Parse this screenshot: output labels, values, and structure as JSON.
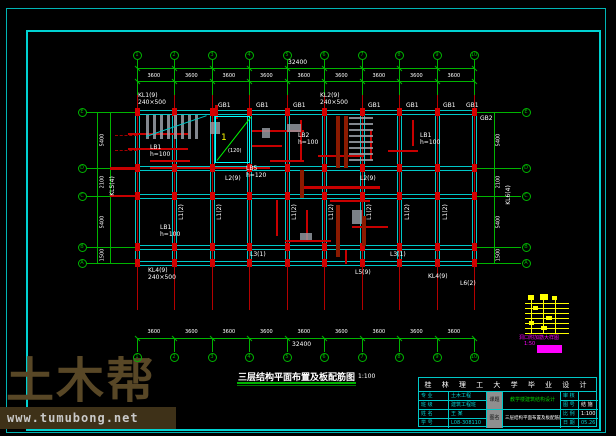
{
  "watermark": {
    "logo_text": "土木帮",
    "site_text": "www.tumubong.net"
  },
  "drawing_title": {
    "text": "三层结构平面布置及板配筋图",
    "scale_label": "1:100"
  },
  "title_block": {
    "header": "桂 林 理 工 大 学 毕 业 设 计",
    "left_rows": [
      {
        "label": "专 业",
        "value": "土木工程"
      },
      {
        "label": "班 级",
        "value": "建筑工程班"
      },
      {
        "label": "姓 名",
        "value": "王 某"
      },
      {
        "label": "学 号",
        "value": "L08-308110"
      }
    ],
    "subject_key": "课题",
    "subject_value": "教学楼建筑结构设计",
    "name_key": "图名",
    "name_value": "三层结构平面布置及板配筋图",
    "right_rows": [
      {
        "label": "审 核",
        "value": ""
      },
      {
        "label": "图 号",
        "value": "结 施"
      },
      {
        "label": "比 例",
        "value": "1:100"
      },
      {
        "label": "日 期",
        "value": "05.26"
      }
    ]
  },
  "legend": {
    "caption1": "洞口附加筋大样图",
    "caption2": "1:50"
  },
  "plan": {
    "axes_x": [
      137,
      174,
      212,
      249,
      287,
      324,
      362,
      399,
      437,
      474
    ],
    "axes_y": [
      112,
      168,
      196,
      247,
      263
    ],
    "bubble_labels_x": [
      "1",
      "2",
      "3",
      "4",
      "5",
      "6",
      "7",
      "8",
      "9",
      "10"
    ],
    "bubble_labels_y": [
      "E",
      "D",
      "C",
      "B",
      "A"
    ],
    "colors": {
      "grid": "#00b400",
      "beam": "#00c8c8",
      "axis_red": "#b40000",
      "column": "#d40000",
      "rebar": "#c80000",
      "wall": "#8b1a00",
      "hatch": "#9aa0a8",
      "detail": "#00ff00",
      "bright": "#00ffff",
      "yellow": "#ffff00",
      "magenta": "#ff00ff",
      "text": "#ffffff"
    }
  },
  "dimensions": {
    "top_total": "32400",
    "top_bays": [
      "3600",
      "3600",
      "3600",
      "3600",
      "3600",
      "3600",
      "3600",
      "3600",
      "3600"
    ],
    "bottom_bays": [
      "3600",
      "3600",
      "3600",
      "3600",
      "3600",
      "3600",
      "3600",
      "3600",
      "3600"
    ],
    "bottom_total": "32400",
    "left_bays": [
      "5400",
      "2100",
      "5400",
      "1500"
    ],
    "right_bays": [
      "5400",
      "2100",
      "5400",
      "1500"
    ]
  },
  "labels": [
    {
      "x": 138,
      "y": 93,
      "t": "KL1(9)"
    },
    {
      "x": 138,
      "y": 100,
      "t": "240×500"
    },
    {
      "x": 218,
      "y": 103,
      "t": "GB1"
    },
    {
      "x": 256,
      "y": 103,
      "t": "GB1"
    },
    {
      "x": 293,
      "y": 103,
      "t": "GB1"
    },
    {
      "x": 320,
      "y": 93,
      "t": "KL2(9)"
    },
    {
      "x": 320,
      "y": 100,
      "t": "240×500"
    },
    {
      "x": 368,
      "y": 103,
      "t": "GB1"
    },
    {
      "x": 406,
      "y": 103,
      "t": "GB1"
    },
    {
      "x": 443,
      "y": 103,
      "t": "GB1"
    },
    {
      "x": 466,
      "y": 103,
      "t": "GB1"
    },
    {
      "x": 480,
      "y": 116,
      "t": "GB2"
    },
    {
      "x": 150,
      "y": 145,
      "t": "LB1"
    },
    {
      "x": 150,
      "y": 152,
      "t": "h=100"
    },
    {
      "x": 298,
      "y": 133,
      "t": "LB2"
    },
    {
      "x": 298,
      "y": 140,
      "t": "h=100"
    },
    {
      "x": 420,
      "y": 133,
      "t": "LB1"
    },
    {
      "x": 420,
      "y": 140,
      "t": "h=100"
    },
    {
      "x": 225,
      "y": 176,
      "t": "L2(9)"
    },
    {
      "x": 360,
      "y": 176,
      "t": "L2(9)"
    },
    {
      "x": 182,
      "y": 212,
      "t": "L1(2)",
      "rot": true
    },
    {
      "x": 220,
      "y": 212,
      "t": "L1(2)",
      "rot": true
    },
    {
      "x": 295,
      "y": 212,
      "t": "L1(2)",
      "rot": true
    },
    {
      "x": 332,
      "y": 212,
      "t": "L1(2)",
      "rot": true
    },
    {
      "x": 370,
      "y": 212,
      "t": "L1(2)",
      "rot": true
    },
    {
      "x": 408,
      "y": 212,
      "t": "L1(2)",
      "rot": true
    },
    {
      "x": 446,
      "y": 212,
      "t": "L1(2)",
      "rot": true
    },
    {
      "x": 160,
      "y": 225,
      "t": "LB1"
    },
    {
      "x": 160,
      "y": 232,
      "t": "h=100"
    },
    {
      "x": 250,
      "y": 252,
      "t": "L3(1)"
    },
    {
      "x": 390,
      "y": 252,
      "t": "L3(1)"
    },
    {
      "x": 148,
      "y": 268,
      "t": "KL4(9)"
    },
    {
      "x": 148,
      "y": 275,
      "t": "240×500"
    },
    {
      "x": 355,
      "y": 270,
      "t": "L5(9)"
    },
    {
      "x": 428,
      "y": 274,
      "t": "KL4(9)"
    },
    {
      "x": 460,
      "y": 281,
      "t": "L6(2)"
    },
    {
      "x": 246,
      "y": 166,
      "t": "LB5"
    },
    {
      "x": 246,
      "y": 173,
      "t": "h=120"
    },
    {
      "x": 228,
      "y": 149,
      "t": "(120)",
      "fs": 5
    },
    {
      "x": 509,
      "y": 195,
      "t": "KL6(4)",
      "rot": true
    },
    {
      "x": 113,
      "y": 186,
      "t": "KL5(4)",
      "rot": true
    }
  ],
  "rebars": [
    {
      "x": 128,
      "y": 133,
      "w": 60,
      "h": 2
    },
    {
      "x": 128,
      "y": 148,
      "w": 60,
      "h": 2
    },
    {
      "x": 150,
      "y": 160,
      "w": 40,
      "h": 2
    },
    {
      "x": 252,
      "y": 130,
      "w": 52,
      "h": 2
    },
    {
      "x": 252,
      "y": 145,
      "w": 30,
      "h": 2
    },
    {
      "x": 300,
      "y": 120,
      "w": 2,
      "h": 40
    },
    {
      "x": 318,
      "y": 155,
      "w": 46,
      "h": 2
    },
    {
      "x": 270,
      "y": 160,
      "w": 34,
      "h": 2
    },
    {
      "x": 276,
      "y": 200,
      "w": 2,
      "h": 36
    },
    {
      "x": 306,
      "y": 210,
      "w": 2,
      "h": 30
    },
    {
      "x": 330,
      "y": 200,
      "w": 40,
      "h": 2
    },
    {
      "x": 352,
      "y": 226,
      "w": 36,
      "h": 2
    },
    {
      "x": 285,
      "y": 240,
      "w": 46,
      "h": 2
    },
    {
      "x": 345,
      "y": 250,
      "w": 2,
      "h": 14
    },
    {
      "x": 370,
      "y": 130,
      "w": 2,
      "h": 30
    },
    {
      "x": 388,
      "y": 150,
      "w": 30,
      "h": 2
    },
    {
      "x": 300,
      "y": 186,
      "w": 80,
      "h": 3
    },
    {
      "x": 150,
      "y": 167,
      "w": 120,
      "h": 2
    },
    {
      "x": 215,
      "y": 105,
      "w": 3,
      "h": 14
    },
    {
      "x": 412,
      "y": 120,
      "w": 2,
      "h": 26
    },
    {
      "x": 110,
      "y": 167,
      "w": 27,
      "h": 3
    },
    {
      "x": 110,
      "y": 195,
      "w": 27,
      "h": 2
    }
  ],
  "walls": [
    {
      "x": 336,
      "y": 116,
      "w": 4,
      "h": 52
    },
    {
      "x": 344,
      "y": 116,
      "w": 4,
      "h": 52
    },
    {
      "x": 336,
      "y": 205,
      "w": 4,
      "h": 52
    },
    {
      "x": 300,
      "y": 170,
      "w": 4,
      "h": 28
    },
    {
      "x": 362,
      "y": 216,
      "w": 4,
      "h": 30
    }
  ],
  "hatch_blobs": [
    {
      "x": 210,
      "y": 122,
      "w": 10,
      "h": 12
    },
    {
      "x": 287,
      "y": 124,
      "w": 14,
      "h": 8
    },
    {
      "x": 262,
      "y": 128,
      "w": 8,
      "h": 10
    },
    {
      "x": 300,
      "y": 233,
      "w": 12,
      "h": 7
    },
    {
      "x": 352,
      "y": 210,
      "w": 10,
      "h": 14
    }
  ],
  "stair_detail": {
    "num": "1"
  }
}
